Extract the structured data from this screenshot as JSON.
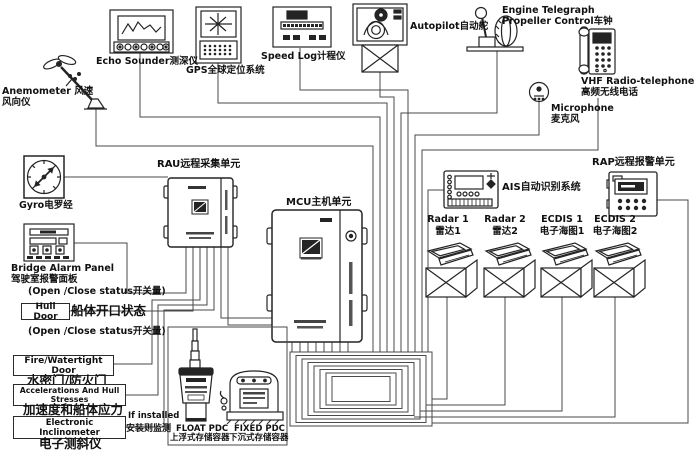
{
  "devices": {
    "anemometer": {
      "label": "Anemometer 风速风向仪"
    },
    "echo_sounder": {
      "label": "Echo Sounder测深仪"
    },
    "gps": {
      "label": "GPS全球定位系统"
    },
    "speed_log": {
      "label": "Speed Log计程仪"
    },
    "autopilot": {
      "label": "Autopilot自动舵"
    },
    "engine_telegraph": {
      "line1": "Engine Telegraph",
      "line2": "Propeller Control车钟"
    },
    "vhf": {
      "line1": "VHF Radio-telephone",
      "line2": "高频无线电话"
    },
    "microphone": {
      "line1": "Microphone",
      "line2": "麦克风"
    },
    "gyro": {
      "label": "Gyro电罗经"
    },
    "rau": {
      "label": "RAU远程采集单元"
    },
    "bridge_alarm_panel": {
      "line1": "Bridge Alarm Panel",
      "line2": "驾驶室报警面板",
      "status": "(Open /Close status开关量)"
    },
    "hull_door": {
      "box": "Hull Door",
      "side": "船体开口状态",
      "status": "(Open /Close status开关量)"
    },
    "fire_watertight_door": {
      "box": "Fire/Watertight Door",
      "below": "水密门/防火门"
    },
    "accelerations": {
      "box": "Accelerations And Hull Stresses",
      "below": "加速度和船体应力"
    },
    "inclinometer": {
      "box": "Electronic  Inclinometer",
      "below": "电子测斜仪",
      "note1": "If installed",
      "note2": "安装则监测"
    },
    "mcu": {
      "label": "MCU主机单元"
    },
    "float_pdc": {
      "line1": "FLOAT PDC",
      "line2": "上浮式存储容器"
    },
    "fixed_pdc": {
      "line1": "FIXED PDC",
      "line2": "下沉式存储容器"
    },
    "ais": {
      "label": "AIS自动识别系统"
    },
    "rap": {
      "label": "RAP远程报警单元"
    },
    "radar1": {
      "line1": "Radar 1",
      "line2": "雷达1"
    },
    "radar2": {
      "line1": "Radar 2",
      "line2": "雷达2"
    },
    "ecdis1": {
      "line1": "ECDIS 1",
      "line2": "电子海图1"
    },
    "ecdis2": {
      "line1": "ECDIS 2",
      "line2": "电子海图2"
    }
  },
  "colors": {
    "wire": "#4a4a4a",
    "ink": "#1a1a1a",
    "background": "#ffffff"
  }
}
